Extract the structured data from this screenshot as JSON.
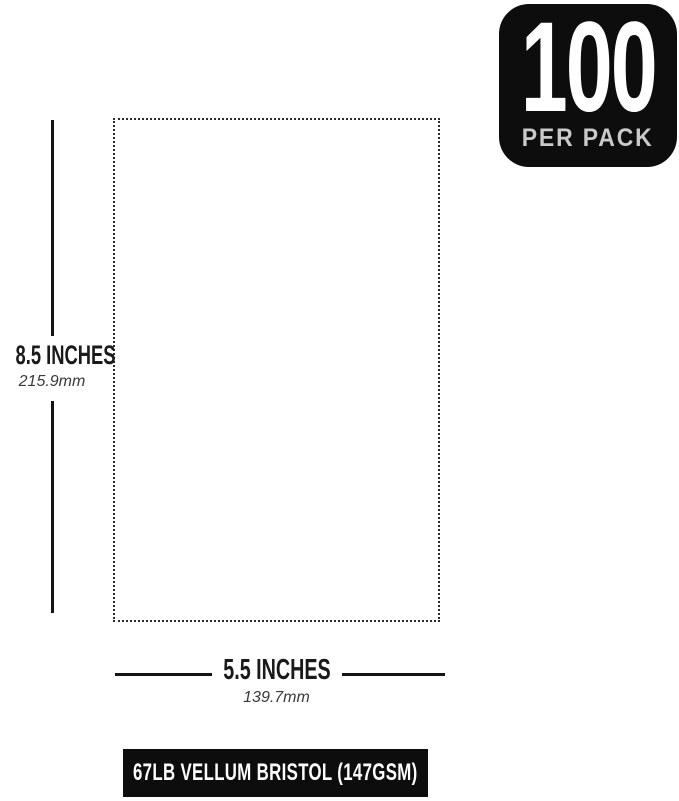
{
  "page": {
    "background_color": "#ffffff",
    "foreground_color": "#141414"
  },
  "badge": {
    "count": "100",
    "label": "PER PACK",
    "bg_color": "#0d0d0d",
    "count_color": "#ffffff",
    "label_color": "#c9c9c9"
  },
  "sheet": {
    "border_style": "dotted",
    "border_color": "#2a2a2a"
  },
  "height_dimension": {
    "inches": "8.5 INCHES",
    "mm": "215.9mm"
  },
  "width_dimension": {
    "inches": "5.5 INCHES",
    "mm": "139.7mm"
  },
  "footer": {
    "label": "67LB VELLUM BRISTOL (147GSM)",
    "bg_color": "#0d0d0d",
    "text_color": "#ffffff"
  }
}
